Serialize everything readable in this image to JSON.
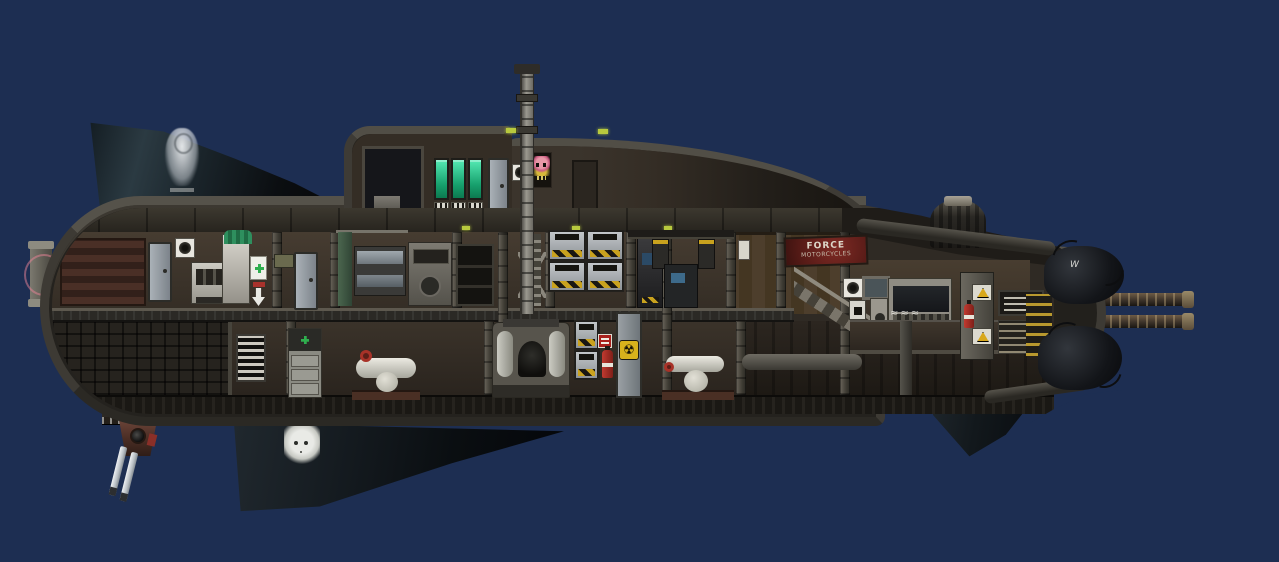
{
  "scene": {
    "type": "game-screenshot",
    "subject": "pixel-art submarine side cutaway in open water",
    "background_color": "#1d2e52"
  },
  "texts": {
    "force_poster_line1": "FORCE",
    "force_poster_line2": "MOTORCYCLES",
    "console_graffiti": "≈≈≈",
    "stern_graffiti": "W",
    "radiation_symbol": "☢"
  },
  "colors": {
    "background": "#1d2e52",
    "hull": "#24221e",
    "hull_edge": "#4f4c44",
    "room_brown": "#3b332a",
    "wood_wall": "#4a3c2c",
    "terminal_green": "#2fbf8f",
    "hazard_yellow": "#c9a21e",
    "medical_green": "#2fae4e",
    "extinguisher_red": "#b2322a",
    "radiation_yellow": "#d8b21c",
    "poster_red": "#6e201c",
    "curtain_green": "#4d6b52",
    "sonar_ring_pink": "#ec8498"
  },
  "structures": [
    "dorsal-fin",
    "keel-fin",
    "stern-fin",
    "conning-tower",
    "sail-hump",
    "periscope-mast",
    "stern-dome",
    "stern-thruster-pods",
    "stern-docking-rails",
    "bow-turret",
    "bow-bracket",
    "upper-deck",
    "lower-deck",
    "ballast-compartment"
  ],
  "equipment_upper_deck": [
    "storage-machine",
    "crew-door",
    "wall-fan-vent",
    "fabricator",
    "autodoc-machine",
    "medical-cabinet",
    "floor-arrow-decal",
    "oil-gauge",
    "crew-door-2",
    "bunk-curtain",
    "bunk-bed",
    "deconstructor",
    "storage-rack",
    "ladder-frame",
    "supply-lockers",
    "loader-console",
    "overhead-hoists",
    "ammo-console",
    "force-poster",
    "stairs",
    "command-fan",
    "small-monitor",
    "status-console",
    "gauge-panel",
    "switch-panel",
    "console-desk",
    "hazard-pillar",
    "fire-extinguisher",
    "junction-box",
    "relay-panel"
  ],
  "equipment_lower_deck": [
    "breaker-panel",
    "drawer-cabinet",
    "pump-compressor",
    "nuclear-reactor",
    "hazard-lockers",
    "warning-plate",
    "fire-extinguisher-2",
    "reactor-door-radiation",
    "pump-compressor-2",
    "engine-pipe",
    "riser-pipe",
    "stern-stripe-panel"
  ],
  "decals": [
    "ghost-figure-fin-decal",
    "skull-keel-decal",
    "skull-poster-conning-tower",
    "console-graffiti",
    "stern-pod-graffiti"
  ],
  "icons": [
    {
      "name": "medical-cross-icon",
      "glyph": "+"
    },
    {
      "name": "radiation-icon",
      "glyph": "☢"
    },
    {
      "name": "down-arrow-icon",
      "glyph": "↓"
    },
    {
      "name": "hazard-triangle-icon",
      "glyph": "⚠"
    },
    {
      "name": "fan-icon",
      "glyph": "●"
    },
    {
      "name": "skull-icon",
      "glyph": "☠"
    }
  ]
}
